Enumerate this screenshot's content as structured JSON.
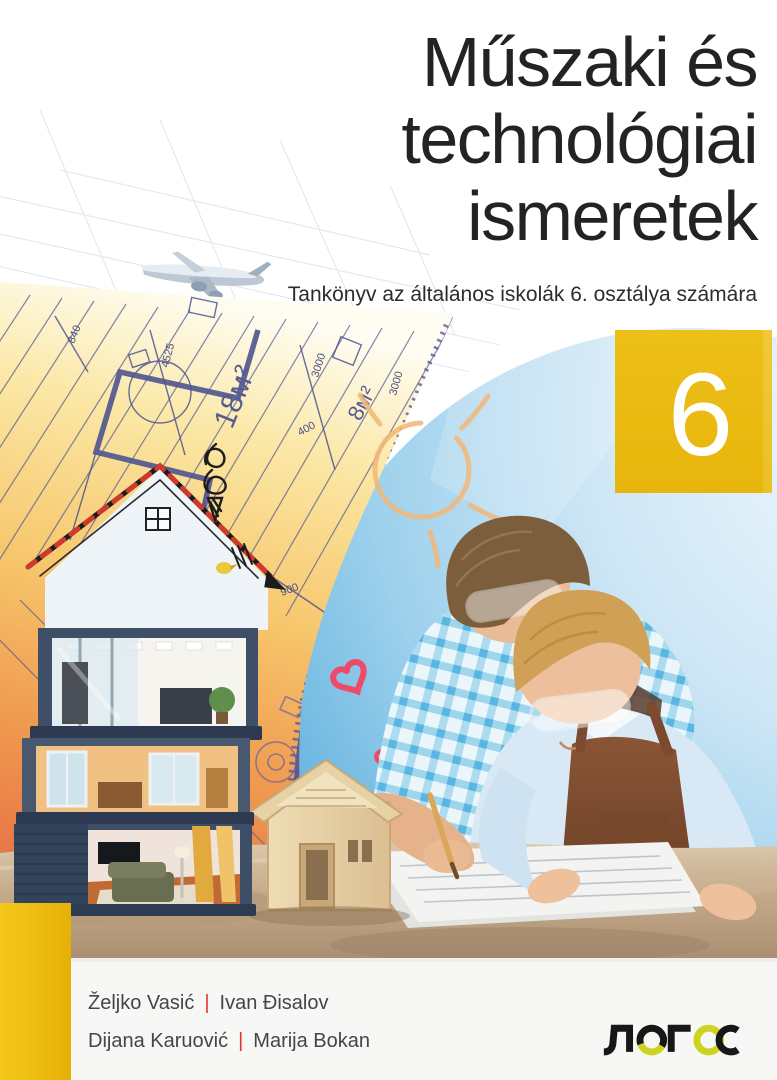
{
  "title": {
    "line1": "Műszaki és",
    "line2": "technológiai",
    "line3": "ismeretek"
  },
  "subtitle": "Tankönyv az általános iskolák 6. osztálya számára",
  "grade_badge": {
    "number": "6"
  },
  "authors": {
    "separator": "|",
    "row1": {
      "left": "Željko Vasić",
      "right": "Ivan Đisalov"
    },
    "row2": {
      "left": "Dijana Karuović",
      "right": "Marija Bokan"
    }
  },
  "publisher": {
    "logo_text": "ЛОГОС"
  },
  "blueprint": {
    "area_labels": {
      "large": "18м²",
      "small": "8м²"
    },
    "dimensions": [
      "4525",
      "3000",
      "840",
      "400",
      "1000",
      "1400",
      "900"
    ]
  },
  "colors": {
    "accent_yellow": "#e9b90e",
    "logo_yellow": "#ced221",
    "separator_red": "#e0372e",
    "title_black": "#232323",
    "sky_blue": "#4aa3d8",
    "blueprint_orange": "#f5a54e",
    "blueprint_line": "#575d96"
  }
}
